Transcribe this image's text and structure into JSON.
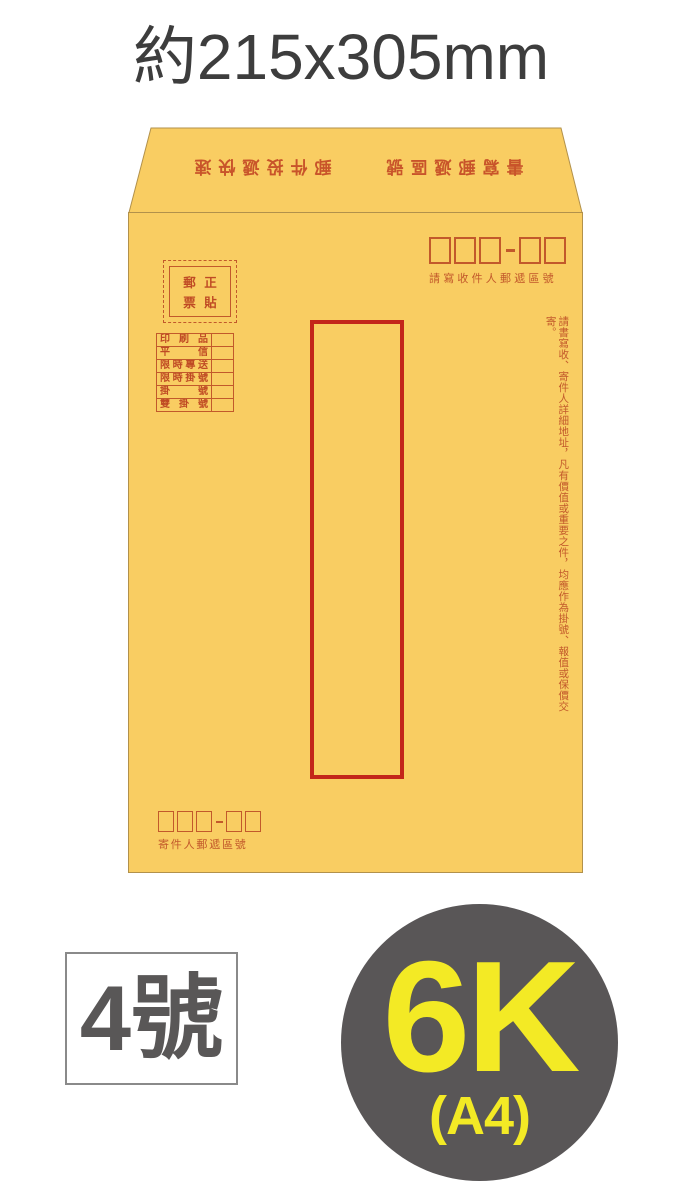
{
  "title": "約215x305mm",
  "envelope": {
    "flap_text_rotated_180": "書寫郵遞區號　　郵件投遞快速",
    "stamp_box": {
      "chars": [
        "郵",
        "正",
        "票",
        "貼"
      ],
      "meaning": "郵票正貼"
    },
    "recipient_zip": {
      "label": "請寫收件人郵遞區號",
      "boxes_major": 3,
      "boxes_minor": 2,
      "separator": "-"
    },
    "mail_types": [
      "印刷品",
      "平信",
      "限時專送",
      "限時掛號",
      "掛號",
      "雙掛號"
    ],
    "notice_vertical": "請書寫收、寄件人詳細地址，凡有價值或重要之件，均應作為掛號、報值或保價交寄。",
    "sender_zip": {
      "label": "寄件人郵遞區號",
      "boxes_major": 3,
      "boxes_minor": 2,
      "separator": "-"
    }
  },
  "badges": {
    "size_label": "4號",
    "paper_size": "6K",
    "paper_size_sub": "(A4)"
  },
  "colors": {
    "paper": "#f9cd62",
    "print_red": "#c2592b",
    "window_red": "#c3261a",
    "title_text": "#3d3d3d",
    "badge_text": "#595757",
    "badge_border": "#8a8a8a",
    "circle_bg": "#595657",
    "circle_text": "#f3ea25"
  }
}
